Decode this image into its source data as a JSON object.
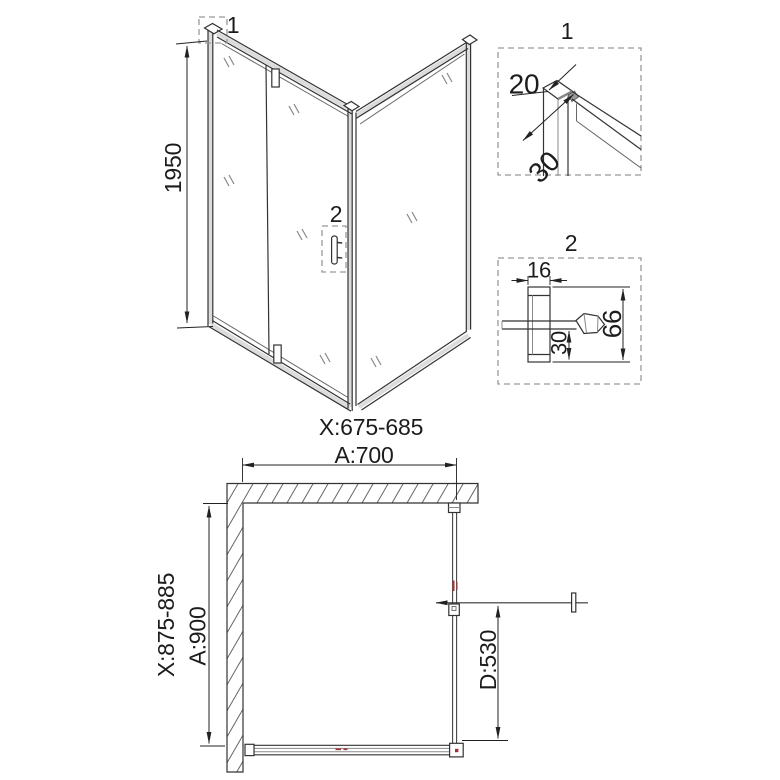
{
  "colors": {
    "line": "#333333",
    "dimension": "#222222",
    "accent_red": "#a33333",
    "dashed_box": "#999999"
  },
  "iso_view": {
    "height_dim": "1950",
    "callout_1": "1",
    "callout_2": "2",
    "width_range": "X:675-685"
  },
  "detail_1": {
    "title": "1",
    "dim_profile_depth": "20",
    "dim_profile_width": "30"
  },
  "detail_2": {
    "title": "2",
    "dim_handle_width": "16",
    "dim_handle_height": "66",
    "dim_handle_offset": "30"
  },
  "plan_view": {
    "dim_top_width": "A:700",
    "dim_left_range": "X:875-885",
    "dim_left_depth": "A:900",
    "dim_door_width": "D:530"
  }
}
